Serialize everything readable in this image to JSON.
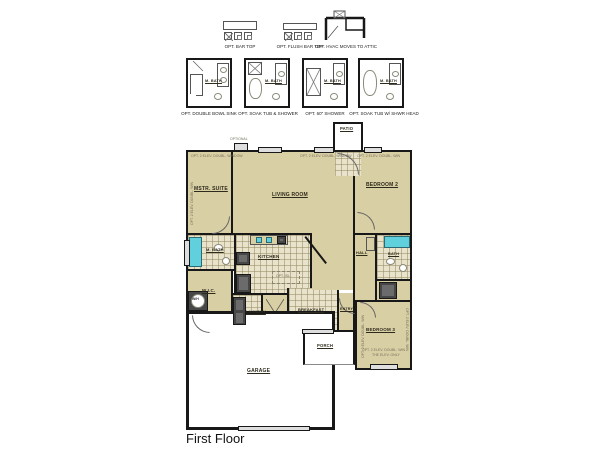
{
  "title": {
    "label": "First Floor"
  },
  "top_options": [
    {
      "label": "OPT. BAR TOP"
    },
    {
      "label": "OPT. FLUSH BAR TOP"
    },
    {
      "label": "OPT. HVAC MOVES TO ATTIC"
    }
  ],
  "bath_options": [
    {
      "label": "OPT. DOUBLE BOWL SINK",
      "room": "M. BATH"
    },
    {
      "label": "OPT. SOAK TUB & SHOWER",
      "room": "M. BATH"
    },
    {
      "label": "OPT. 60\" SHOWER",
      "room": "M. BATH"
    },
    {
      "label": "OPT. SOAK TUB W/ SHWR HEAD",
      "room": "M. BATH"
    }
  ],
  "rooms": {
    "patio": "PATIO",
    "mstr_suite": "MSTR. SUITE",
    "living_room": "LIVING ROOM",
    "bedroom2": "BEDROOM 2",
    "m_bath": "M. BATH",
    "wic": "W.I.C.",
    "kitchen": "KITCHEN",
    "laundry": "LAUNDRY",
    "breakfast": "BREAKFAST",
    "entry": "ENTRY",
    "hall": "HALL",
    "bath": "BATH",
    "bedroom3": "BEDROOM 3",
    "porch": "PORCH",
    "garage": "GARAGE",
    "water_heater": "W/H"
  },
  "annotations": {
    "optional": "OPTIONAL",
    "opt_window": "OPT. 2 ELEV. DOUBL. WINDOW",
    "opt_window_short": "OPT. 2 ELEV. DOUBL. WIN",
    "elev_only": "THE ELEV. ONLY",
    "opt_island": "OPT. ISL."
  },
  "colors": {
    "floor_tan": "#d9cfa4",
    "tile_cream": "#e9e3cb",
    "tub_cyan": "#5fd0dc",
    "wall_black": "#181818",
    "window_gray": "#dedede",
    "appliance_gray": "#474747"
  }
}
